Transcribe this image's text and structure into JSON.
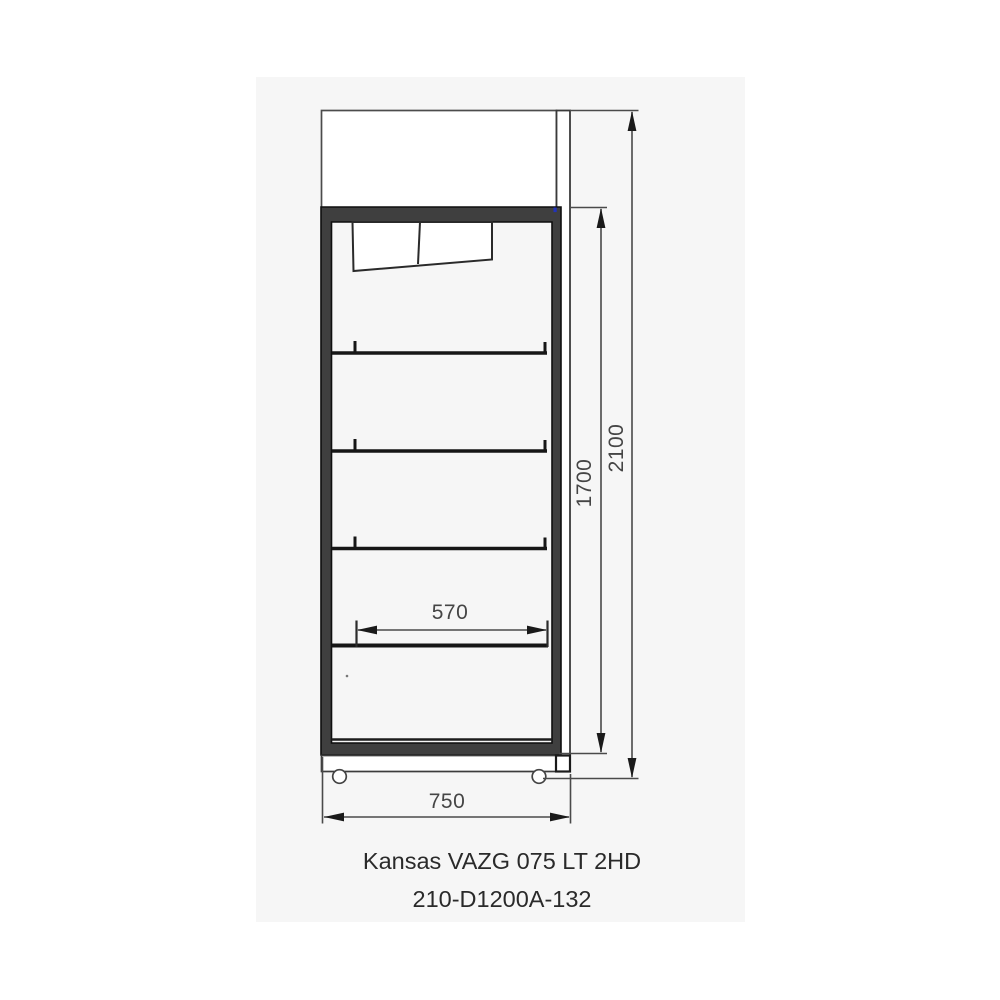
{
  "drawing": {
    "caption_line1": "Kansas VAZG 075 LT 2HD",
    "caption_line2": "210-D1200A-132",
    "dim_overall_height": "2100",
    "dim_interior_height": "1700",
    "dim_shelf_width": "570",
    "dim_overall_width": "750"
  },
  "colors": {
    "page_bg": "#ffffff",
    "panel_bg": "#f6f6f6",
    "thin_line": "#4a4a4a",
    "frame_fill": "#3f3f3f",
    "frame_stroke": "#0f0f0f",
    "shelf_line": "#161616",
    "caption_text": "#2a2a2a",
    "blue_mark": "#2233bb"
  }
}
